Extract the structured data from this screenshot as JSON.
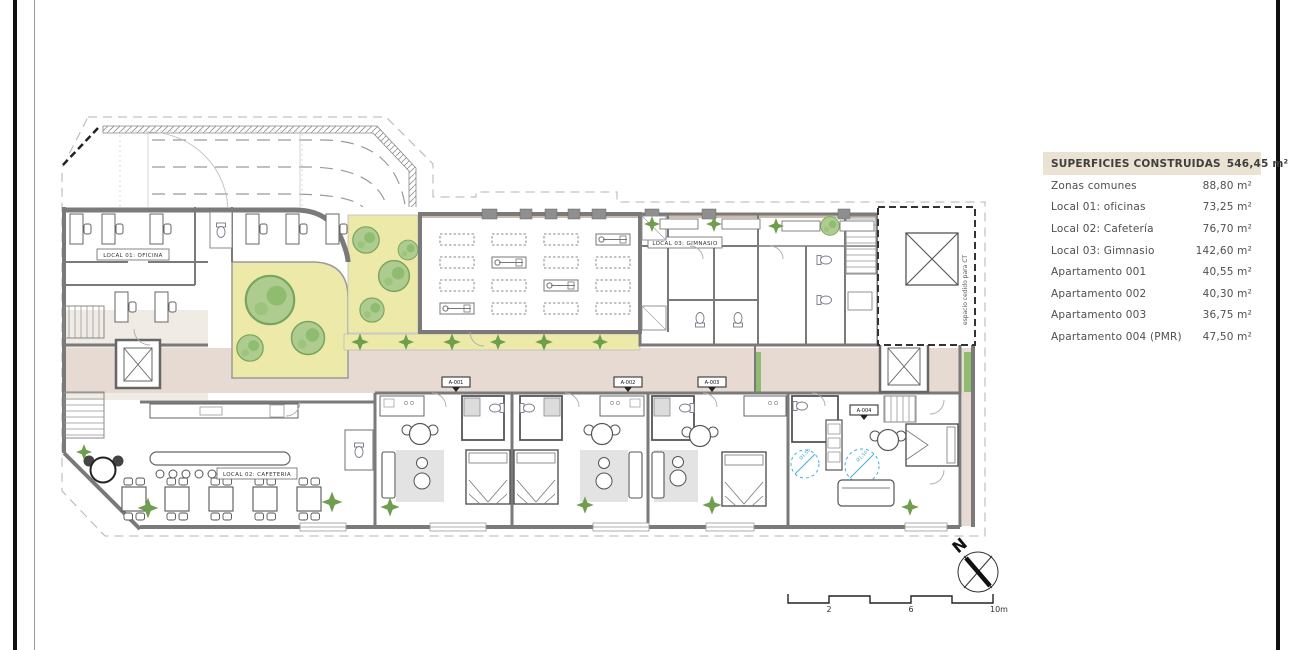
{
  "plan": {
    "rooms": {
      "office_label": "LOCAL 01: OFICINA",
      "cafeteria_label": "LOCAL 02: CAFETERIA",
      "gym_label": "LOCAL 03: GIMNASIO"
    },
    "apartments": [
      "A-001",
      "A-002",
      "A-003",
      "A-004"
    ],
    "ct_note": "espacio cedido para CT",
    "pmr_radius": "Ø1,50"
  },
  "legend": {
    "header": {
      "label": "SUPERFICIES CONSTRUIDAS",
      "value": "546,45 m²"
    },
    "rows": [
      {
        "label": "Zonas comunes",
        "value": "88,80 m²"
      },
      {
        "label": "Local 01: oficinas",
        "value": "73,25 m²"
      },
      {
        "label": "Local 02: Cafetería",
        "value": "76,70 m²"
      },
      {
        "label": "Local 03: Gimnasio",
        "value": "142,60 m²"
      },
      {
        "label": "Apartamento 001",
        "value": "40,55 m²"
      },
      {
        "label": "Apartamento 002",
        "value": "40,30 m²"
      },
      {
        "label": "Apartamento 003",
        "value": "36,75 m²"
      },
      {
        "label": "Apartamento 004 (PMR)",
        "value": "47,50 m²"
      }
    ]
  },
  "compass": {
    "north_label": "N"
  },
  "scalebar": {
    "ticks": [
      "2",
      "6",
      "10m"
    ]
  },
  "colors": {
    "wall": "#7a7a7a",
    "corridor": "#e6dad2",
    "garden": "#edeaa9",
    "tree": "#a9c98b",
    "plant": "#6f9e4f",
    "legend_header_bg": "#eae2d2",
    "pmr_blue": "#41b0d9",
    "text": "#4a4a4a"
  }
}
